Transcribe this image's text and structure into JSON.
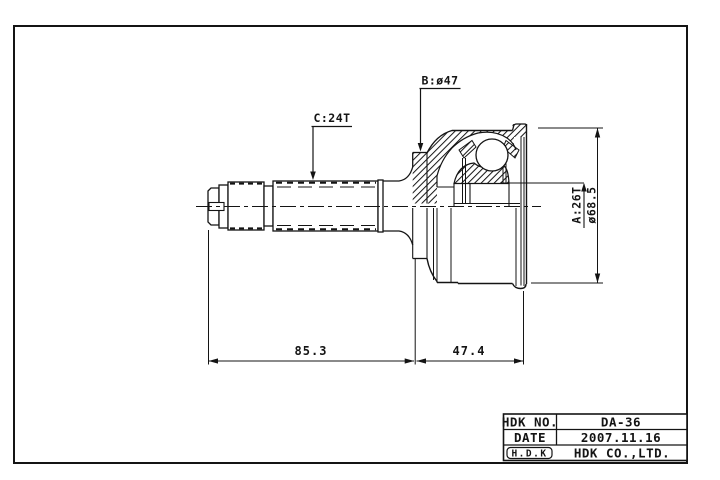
{
  "drawing": {
    "callouts": {
      "shaft_spline": "C:24T",
      "boot_groove_dia": "B:ø47",
      "inner_race_spline": "A:26T",
      "outer_dia": "ø68.5"
    },
    "dimensions": {
      "shaft_length": "85.3",
      "joint_length": "47.4"
    }
  },
  "title_block": {
    "part_no_label": "HDK NO.",
    "part_no": "DA-36",
    "date_label": "DATE",
    "date": "2007.11.16",
    "logo": "H.D.K",
    "company": "HDK CO.,LTD."
  }
}
